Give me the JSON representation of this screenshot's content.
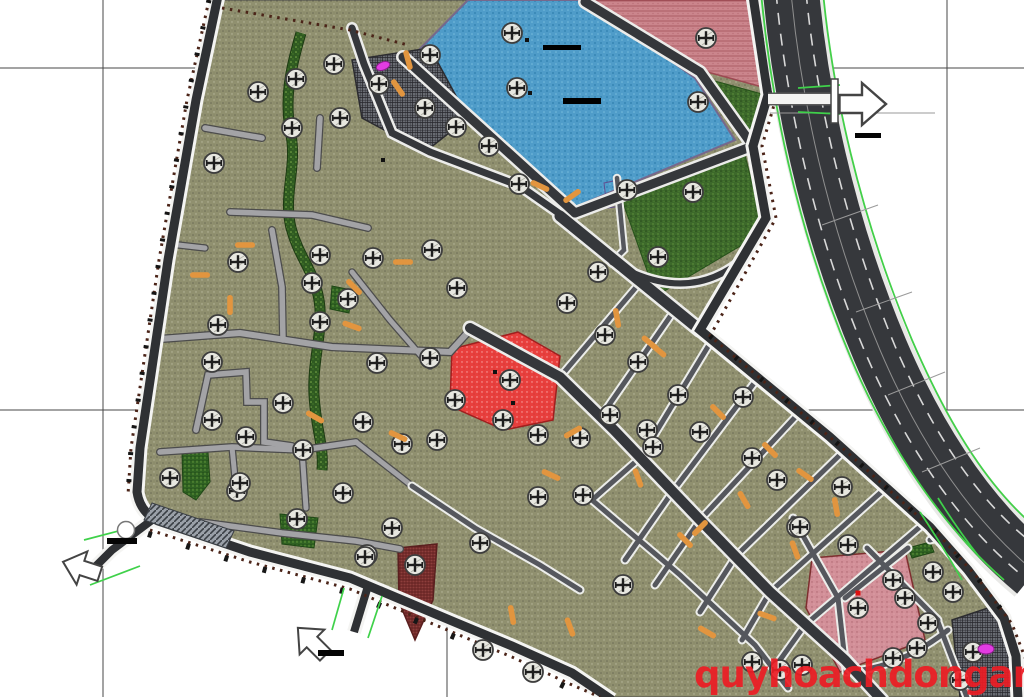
{
  "watermark": {
    "text": "quyhoachdonganh.com",
    "color": "#ed1c24"
  },
  "canvas": {
    "w": 1024,
    "h": 697,
    "bg": "#ffffff"
  },
  "grid": {
    "color": "#474747",
    "verticals": [
      {
        "x": 103,
        "y1": 0,
        "y2": 697
      },
      {
        "x": 447,
        "y1": 0,
        "y2": 697
      },
      {
        "x": 790,
        "y1": 410,
        "y2": 697
      },
      {
        "x": 947,
        "y1": 0,
        "y2": 410
      }
    ],
    "horizontals": [
      {
        "y": 68,
        "x1": 0,
        "x2": 1024
      },
      {
        "y": 410,
        "x1": 0,
        "x2": 1024
      }
    ]
  },
  "site_outline": [
    [
      218,
      0
    ],
    [
      752,
      0
    ],
    [
      768,
      95
    ],
    [
      752,
      146
    ],
    [
      766,
      218
    ],
    [
      700,
      330
    ],
    [
      830,
      437
    ],
    [
      930,
      527
    ],
    [
      968,
      570
    ],
    [
      1004,
      618
    ],
    [
      1017,
      660
    ],
    [
      1018,
      697
    ],
    [
      612,
      697
    ],
    [
      572,
      673
    ],
    [
      512,
      646
    ],
    [
      452,
      621
    ],
    [
      350,
      578
    ],
    [
      250,
      552
    ],
    [
      158,
      521
    ],
    [
      140,
      492
    ],
    [
      140,
      448
    ],
    [
      168,
      260
    ],
    [
      196,
      100
    ]
  ],
  "stream": {
    "d": "M301,33 C290,70 284,100 291,135 C297,168 283,195 291,228 C299,258 314,270 319,300 C324,330 312,360 314,395 C316,430 324,445 322,470",
    "w": 9
  },
  "parcels": [
    {
      "name": "lake",
      "fill": "lake",
      "stroke": "#76688c",
      "sw": 2,
      "pts": [
        [
          412,
          57
        ],
        [
          468,
          0
        ],
        [
          585,
          0
        ],
        [
          695,
          78
        ],
        [
          735,
          140
        ],
        [
          575,
          207
        ]
      ]
    },
    {
      "name": "school-pink-zone",
      "fill": "pink",
      "stroke": "#9c4a52",
      "sw": 1.5,
      "pts": [
        [
          592,
          0
        ],
        [
          752,
          0
        ],
        [
          766,
          88
        ],
        [
          700,
          70
        ]
      ]
    },
    {
      "name": "green-triangle",
      "fill": "park",
      "stroke": "#26511a",
      "sw": 1,
      "pts": [
        [
          704,
          78
        ],
        [
          762,
          94
        ],
        [
          751,
          142
        ]
      ]
    },
    {
      "name": "central-park",
      "fill": "park",
      "stroke": "#26511a",
      "sw": 1,
      "pts": [
        [
          622,
          200
        ],
        [
          745,
          155
        ],
        [
          764,
          232
        ],
        [
          656,
          296
        ]
      ]
    },
    {
      "name": "dark-hatched-parcel-top",
      "fill": "dark",
      "stroke": "#2c2c30",
      "sw": 1.5,
      "pts": [
        [
          352,
          60
        ],
        [
          430,
          48
        ],
        [
          468,
          118
        ],
        [
          425,
          152
        ],
        [
          362,
          118
        ]
      ]
    },
    {
      "name": "red-commercial-parcel",
      "fill": "red",
      "stroke": "#a01f1f",
      "sw": 1.5,
      "pts": [
        [
          452,
          349
        ],
        [
          518,
          332
        ],
        [
          560,
          356
        ],
        [
          553,
          420
        ],
        [
          504,
          430
        ],
        [
          450,
          406
        ]
      ]
    },
    {
      "name": "maroon-parcel",
      "fill": "maroon",
      "stroke": "#5a1f1f",
      "sw": 1.5,
      "pts": [
        [
          398,
          548
        ],
        [
          437,
          544
        ],
        [
          433,
          600
        ],
        [
          415,
          640
        ],
        [
          399,
          602
        ]
      ]
    },
    {
      "name": "pink-parcel-bottom-right",
      "fill": "pinkbr",
      "stroke": "#7e2f2f",
      "sw": 1.5,
      "pts": [
        [
          812,
          558
        ],
        [
          905,
          550
        ],
        [
          925,
          640
        ],
        [
          840,
          672
        ],
        [
          806,
          608
        ]
      ]
    },
    {
      "name": "dark-hatched-parcel-bottom-right",
      "fill": "dark",
      "stroke": "#2c2c30",
      "sw": 1.5,
      "pts": [
        [
          952,
          620
        ],
        [
          1000,
          604
        ],
        [
          1013,
          652
        ],
        [
          1014,
          697
        ],
        [
          960,
          697
        ]
      ]
    },
    {
      "name": "green-parcel-1",
      "fill": "green",
      "stroke": "#1f4716",
      "sw": 1,
      "pts": [
        [
          182,
          452
        ],
        [
          208,
          452
        ],
        [
          210,
          482
        ],
        [
          196,
          500
        ],
        [
          183,
          492
        ]
      ]
    },
    {
      "name": "green-parcel-2",
      "fill": "green",
      "stroke": "#1f4716",
      "sw": 1,
      "pts": [
        [
          280,
          514
        ],
        [
          318,
          518
        ],
        [
          314,
          548
        ],
        [
          282,
          544
        ]
      ]
    },
    {
      "name": "green-parcel-3",
      "fill": "green",
      "stroke": "#1f4716",
      "sw": 1,
      "pts": [
        [
          332,
          286
        ],
        [
          352,
          290
        ],
        [
          349,
          313
        ],
        [
          330,
          309
        ]
      ]
    },
    {
      "name": "green-strip-br",
      "fill": "green",
      "stroke": "#1f4716",
      "sw": 1,
      "pts": [
        [
          908,
          548
        ],
        [
          930,
          542
        ],
        [
          934,
          552
        ],
        [
          912,
          558
        ]
      ]
    },
    {
      "name": "purple-parcel",
      "fill": "purple",
      "stroke": "#5f4d8f",
      "sw": 1,
      "pts": [
        [
          604,
          183
        ],
        [
          618,
          180
        ],
        [
          622,
          206
        ],
        [
          607,
          208
        ]
      ]
    }
  ],
  "roads": {
    "lane": [
      {
        "n": "lane-mid-horizontal",
        "w": 6,
        "d": "M133,341 L240,333 L332,347 L450,352 L470,330"
      },
      {
        "n": "lane-1",
        "w": 5.5,
        "d": "M230,212 L312,215 L368,228"
      },
      {
        "n": "lane-2",
        "w": 5.5,
        "d": "M320,118 L317,168"
      },
      {
        "n": "lane-3",
        "w": 5.5,
        "d": "M272,230 L282,287 L283,340"
      },
      {
        "n": "lane-4",
        "w": 5.5,
        "d": "M205,128 L262,138"
      },
      {
        "n": "lane-zigzag",
        "w": 5.5,
        "d": "M196,430 L208,375 L246,372 L247,402 L264,402 L264,442 L292,446"
      },
      {
        "n": "lane-5",
        "w": 5.5,
        "d": "M160,452 L232,447 L302,450 L356,442"
      },
      {
        "n": "lane-6",
        "w": 5,
        "d": "M302,450 L306,508"
      },
      {
        "n": "lane-7",
        "w": 5,
        "d": "M232,447 L236,488"
      },
      {
        "n": "lane-8",
        "w": 5.5,
        "d": "M200,522 L282,533 L356,541 L400,549"
      },
      {
        "n": "lane-9",
        "w": 5,
        "d": "M356,442 L412,486"
      },
      {
        "n": "lane-10",
        "w": 5,
        "d": "M152,242 L205,248"
      },
      {
        "n": "lane-11",
        "w": 5,
        "d": "M352,272 L390,320 L430,366"
      }
    ],
    "street": [
      {
        "n": "cross-street-1",
        "w": 5,
        "d": "M638,285 L560,377"
      },
      {
        "n": "cross-street-2",
        "w": 5,
        "d": "M676,308 L600,418"
      },
      {
        "n": "cross-street-3",
        "w": 5,
        "d": "M712,340 L641,457 L592,500"
      },
      {
        "n": "cross-street-4",
        "w": 5,
        "d": "M758,378 L673,491 L625,560"
      },
      {
        "n": "cross-street-5",
        "w": 5,
        "d": "M800,412 L700,520 L655,585"
      },
      {
        "n": "cross-street-6",
        "w": 5,
        "d": "M845,450 L736,556 L700,612"
      },
      {
        "n": "cross-street-7",
        "w": 5,
        "d": "M888,486 L770,592 L742,640"
      },
      {
        "n": "cross-street-8",
        "w": 5,
        "d": "M928,520 L805,625 L780,660"
      },
      {
        "n": "parallel-street-1",
        "w": 5,
        "d": "M592,500 L680,575 L755,645 L788,688"
      },
      {
        "n": "parallel-street-2",
        "w": 5,
        "d": "M412,486 L475,528 L540,565 L580,590"
      },
      {
        "n": "br-street-1",
        "w": 5,
        "d": "M793,518 L838,598 L846,670"
      },
      {
        "n": "br-street-2",
        "w": 5,
        "d": "M845,598 L908,548"
      },
      {
        "n": "br-street-3",
        "w": 5,
        "d": "M867,548 L938,620"
      },
      {
        "n": "br-street-4",
        "w": 5,
        "d": "M930,540 L975,528"
      },
      {
        "n": "br-street-5",
        "w": 5,
        "d": "M948,630 Q900,668 846,672"
      },
      {
        "n": "br-street-6",
        "w": 5,
        "d": "M938,622 L968,700"
      },
      {
        "n": "park-west-street",
        "w": 4.5,
        "d": "M617,178 L624,250 L612,262"
      }
    ],
    "major": [
      {
        "n": "avenue-main",
        "w": 11,
        "d": "M560,216 L700,330"
      },
      {
        "n": "lake-road-sw",
        "w": 9,
        "d": "M403,57 L575,213"
      },
      {
        "n": "lake-road-ne",
        "w": 9,
        "d": "M585,2 L700,72 L753,146"
      },
      {
        "n": "lake-road-se",
        "w": 9,
        "d": "M575,213 L753,146"
      },
      {
        "n": "avenue-diagonal-2",
        "w": 10,
        "d": "M470,328 L560,377 L614,430 L700,520 L770,592 L845,660 L882,700"
      },
      {
        "n": "top-road-1",
        "w": 7,
        "d": "M352,28 L364,64 L392,133 L430,152"
      },
      {
        "n": "top-road-2",
        "w": 7,
        "d": "M430,152 L520,186 L560,214"
      },
      {
        "n": "park-south-road",
        "w": 6,
        "d": "M612,262 Q700,314 762,240"
      }
    ],
    "boundary": [
      {
        "n": "boundary-west-south",
        "w": 9,
        "d": "M218,-4 L196,100 L168,260 L140,448 L137,492 Q140,512 158,521 L250,552 L350,578 L452,621 L512,646 L572,673 L612,700"
      },
      {
        "n": "boundary-east",
        "w": 9,
        "d": "M753,-4 L768,95 L753,146 L766,218 L700,330 L830,437 L930,527 L968,570 L1004,618 L1016,656 L1018,700"
      },
      {
        "n": "exit-stub-southwest",
        "w": 8,
        "d": "M152,520 L112,550 L94,568"
      },
      {
        "n": "exit-stub-south",
        "w": 8,
        "d": "M368,586 L354,632"
      }
    ]
  },
  "ornaments": [
    {
      "n": "boundary-dots-west",
      "d": "M209,0 L187,100 L159,260 L131,448 L128,495",
      "color": "#4b2418",
      "w": 3,
      "dash": "2.5 5.5"
    },
    {
      "n": "boundary-ticks-west",
      "d": "M209,0 L187,100 L159,260 L131,448 L128,495",
      "color": "#141414",
      "w": 5,
      "dash": "3 24"
    },
    {
      "n": "boundary-dots-south",
      "d": "M150,530 L250,562 L350,589 L452,632 L512,657 L570,684 L600,697",
      "color": "#4b2418",
      "w": 3,
      "dash": "2.5 5.5"
    },
    {
      "n": "boundary-blobs-south",
      "d": "M148,534 L250,566 L350,593 L452,636 L512,661 L568,688",
      "color": "#171717",
      "w": 6,
      "dash": "4 36"
    },
    {
      "n": "boundary-dots-north",
      "d": "M222,8 L350,30 L408,45",
      "color": "#4b2418",
      "w": 3,
      "dash": "2.5 5.5"
    },
    {
      "n": "boundary-dots-east",
      "d": "M762,-4 L777,95 L762,146 L776,218 L710,336 L838,444 L938,534 L976,576 L1012,624 L1026,660",
      "color": "#4b2418",
      "w": 3,
      "dash": "2.5 5.5"
    },
    {
      "n": "boundary-ticks-east",
      "d": "M710,336 L838,444 L938,534 L976,576 L1012,624",
      "color": "#141414",
      "w": 5,
      "dash": "3 30"
    }
  ],
  "green_accents": [
    "M84,540 L130,528",
    "M90,585 L140,566",
    "M344,588 L332,630",
    "M382,596 L368,638",
    "M798,88 L840,85",
    "M798,112 L840,114",
    "M938,498 Q958,530 980,558",
    "M920,512 Q945,550 962,580"
  ],
  "highway": {
    "band": {
      "d": "M791,-8 C800,90 825,220 880,350 C912,425 960,510 1035,572",
      "w": 56,
      "color": "#36383c"
    },
    "edges": [
      "M761,-8 C770,92 795,226 850,356 C882,432 933,518 1004,580",
      "M823,-8 C832,86 858,212 912,340 C944,414 991,502 1060,545"
    ],
    "edge_color": "#43cf49",
    "lanes": [
      "M776,-8 C785,90 810,222 865,352 C897,427 947,512 1018,572",
      "M806,-8 C815,88 841,216 895,346 C927,420 976,506 1045,552"
    ],
    "center": "M791,-8 C800,90 825,220 880,350 C912,425 960,510 1035,572",
    "ticks": [
      "M822,225 L878,205",
      "M856,312 L912,292",
      "M888,395 L945,372",
      "M922,472 L980,448"
    ],
    "cross_line": "M770,113 L935,113"
  },
  "exit_stub_top": {
    "d": "M768,99 L838,99",
    "w": 10
  },
  "signpost": [
    831,
    79,
    7,
    44
  ],
  "arrows": [
    {
      "n": "exit-arrow-east",
      "x": 862,
      "y": 104,
      "rot": 0,
      "s": 1.5
    },
    {
      "n": "exit-arrow-southwest",
      "x": 82,
      "y": 568,
      "rot": 198,
      "s": 1.25
    },
    {
      "n": "exit-arrow-south",
      "x": 312,
      "y": 642,
      "rot": 225,
      "s": 1.25
    }
  ],
  "scale_bars": [
    [
      855,
      133,
      26,
      5
    ],
    [
      107,
      538,
      30,
      6
    ],
    [
      318,
      650,
      26,
      6
    ]
  ],
  "junction": {
    "circle": [
      126,
      530,
      8.5
    ],
    "crosswalk": [
      [
        152,
        503
      ],
      [
        234,
        531
      ],
      [
        226,
        548
      ],
      [
        144,
        520
      ]
    ]
  },
  "trees": [
    [
      296,
      79
    ],
    [
      334,
      64
    ],
    [
      379,
      84
    ],
    [
      258,
      92
    ],
    [
      292,
      128
    ],
    [
      340,
      118
    ],
    [
      214,
      163
    ],
    [
      238,
      262
    ],
    [
      218,
      325
    ],
    [
      212,
      362
    ],
    [
      212,
      420
    ],
    [
      246,
      437
    ],
    [
      170,
      478
    ],
    [
      237,
      491
    ],
    [
      297,
      519
    ],
    [
      320,
      255
    ],
    [
      312,
      283
    ],
    [
      320,
      322
    ],
    [
      348,
      299
    ],
    [
      373,
      258
    ],
    [
      377,
      363
    ],
    [
      363,
      422
    ],
    [
      303,
      450
    ],
    [
      283,
      403
    ],
    [
      240,
      483
    ],
    [
      343,
      493
    ],
    [
      367,
      555
    ],
    [
      392,
      528
    ],
    [
      415,
      565
    ],
    [
      365,
      557
    ],
    [
      480,
      543
    ],
    [
      483,
      650
    ],
    [
      533,
      672
    ],
    [
      430,
      55
    ],
    [
      425,
      108
    ],
    [
      456,
      127
    ],
    [
      489,
      146
    ],
    [
      519,
      184
    ],
    [
      512,
      33
    ],
    [
      517,
      88
    ],
    [
      706,
      38
    ],
    [
      698,
      102
    ],
    [
      432,
      250
    ],
    [
      457,
      288
    ],
    [
      430,
      358
    ],
    [
      455,
      400
    ],
    [
      437,
      440
    ],
    [
      402,
      444
    ],
    [
      510,
      380
    ],
    [
      503,
      420
    ],
    [
      538,
      435
    ],
    [
      580,
      438
    ],
    [
      538,
      497
    ],
    [
      583,
      495
    ],
    [
      598,
      272
    ],
    [
      567,
      303
    ],
    [
      605,
      335
    ],
    [
      638,
      362
    ],
    [
      678,
      395
    ],
    [
      743,
      397
    ],
    [
      610,
      415
    ],
    [
      647,
      430
    ],
    [
      700,
      432
    ],
    [
      653,
      447
    ],
    [
      627,
      190
    ],
    [
      693,
      192
    ],
    [
      658,
      257
    ],
    [
      752,
      458
    ],
    [
      777,
      480
    ],
    [
      797,
      527
    ],
    [
      623,
      585
    ],
    [
      842,
      487
    ],
    [
      800,
      527
    ],
    [
      848,
      545
    ],
    [
      893,
      580
    ],
    [
      933,
      572
    ],
    [
      953,
      592
    ],
    [
      905,
      598
    ],
    [
      858,
      608
    ],
    [
      928,
      623
    ],
    [
      917,
      648
    ],
    [
      893,
      658
    ],
    [
      973,
      652
    ],
    [
      802,
      665
    ],
    [
      960,
      680
    ],
    [
      752,
      662
    ],
    [
      780,
      670
    ]
  ],
  "dashes": [
    [
      408,
      60,
      75
    ],
    [
      398,
      88,
      55
    ],
    [
      540,
      186,
      25
    ],
    [
      572,
      196,
      -35
    ],
    [
      245,
      245,
      0
    ],
    [
      200,
      275,
      0
    ],
    [
      230,
      305,
      90
    ],
    [
      403,
      262,
      0
    ],
    [
      354,
      287,
      45
    ],
    [
      352,
      326,
      20
    ],
    [
      315,
      417,
      30
    ],
    [
      398,
      436,
      25
    ],
    [
      551,
      475,
      25
    ],
    [
      617,
      318,
      80
    ],
    [
      658,
      350,
      40
    ],
    [
      650,
      343,
      40
    ],
    [
      718,
      412,
      45
    ],
    [
      573,
      432,
      -30
    ],
    [
      638,
      478,
      70
    ],
    [
      685,
      540,
      45
    ],
    [
      700,
      528,
      -45
    ],
    [
      744,
      500,
      60
    ],
    [
      770,
      450,
      45
    ],
    [
      805,
      475,
      35
    ],
    [
      836,
      507,
      80
    ],
    [
      795,
      550,
      70
    ],
    [
      512,
      615,
      80
    ],
    [
      570,
      627,
      70
    ],
    [
      767,
      616,
      20
    ],
    [
      707,
      632,
      30
    ]
  ],
  "symbols": {
    "lake_bars": [
      [
        543,
        45,
        38,
        5
      ],
      [
        563,
        98,
        38,
        6
      ]
    ],
    "black_squares": [
      [
        495,
        372
      ],
      [
        513,
        403
      ],
      [
        527,
        40
      ],
      [
        530,
        93
      ],
      [
        383,
        160
      ]
    ],
    "red_squares": [
      [
        858,
        593
      ]
    ],
    "magenta_blobs": [
      [
        383,
        66,
        7,
        4,
        -20
      ],
      [
        986,
        649,
        8,
        5,
        0
      ]
    ]
  }
}
